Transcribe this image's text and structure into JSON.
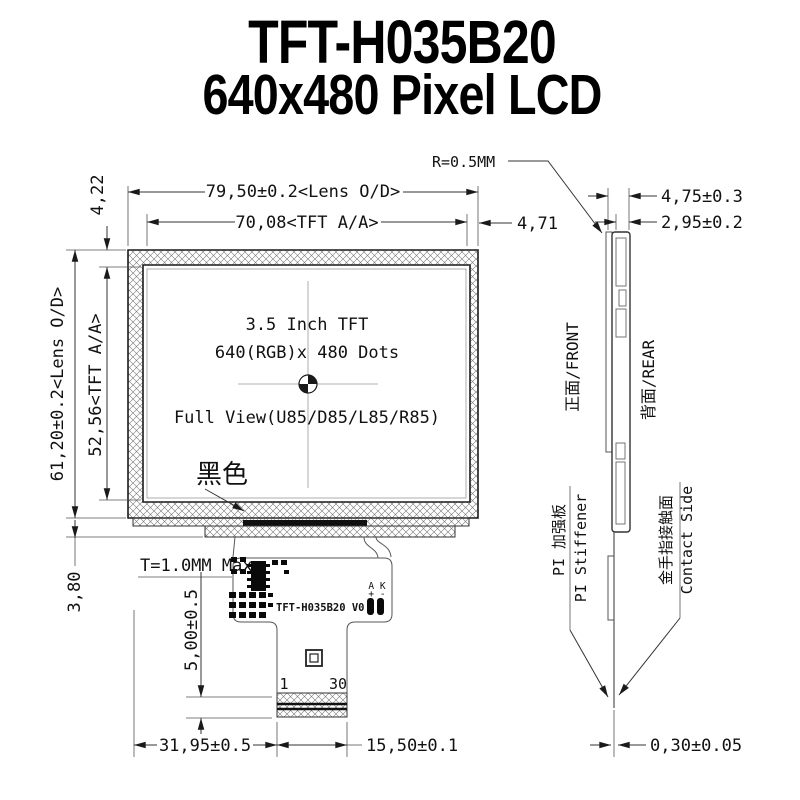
{
  "page": {
    "background": "#ffffff",
    "line_color": "#1a1a1a",
    "hatch_color": "#777777"
  },
  "title": {
    "line1": "TFT-H035B20",
    "line2": "640x480 Pixel LCD"
  },
  "front_view": {
    "screen_text": {
      "size": "3.5 Inch TFT",
      "resolution": "640(RGB)x 480 Dots",
      "view": "Full View(U85/D85/L85/R85)"
    },
    "bezel_color_label": "黑色",
    "thickness_note": "T=1.0MM Max",
    "part_number": "TFT-H035B20 V0",
    "pins": {
      "first": "1",
      "last": "30",
      "backlight": "A K",
      "polarity": "+ -"
    },
    "dimensions": {
      "lens_width": "79,50±0.2<Lens O/D>",
      "active_width": "70,08<TFT A/A>",
      "right_margin": "4,71",
      "top_margin": "4,22",
      "lens_height": "61,20±0.2<Lens O/D>",
      "active_height": "52,56<TFT A/A>",
      "bottom_margin": "3,80",
      "fpc_shoulder": "5,00±0.5",
      "fpc_offset": "31,95±0.5",
      "fpc_tail_width": "15,50±0.1"
    }
  },
  "side_view": {
    "corner_radius": "R=0.5MM",
    "dimensions": {
      "total_thickness": "4,75±0.3",
      "panel_thickness": "2,95±0.2",
      "fpc_thickness": "0,30±0.05"
    },
    "labels": {
      "front": "正面/FRONT",
      "rear": "背面/REAR",
      "stiffener_en": "PI Stiffener",
      "stiffener_cn": "PI 加强板",
      "contact_en": "Contact Side",
      "contact_cn": "金手指接触面"
    }
  }
}
